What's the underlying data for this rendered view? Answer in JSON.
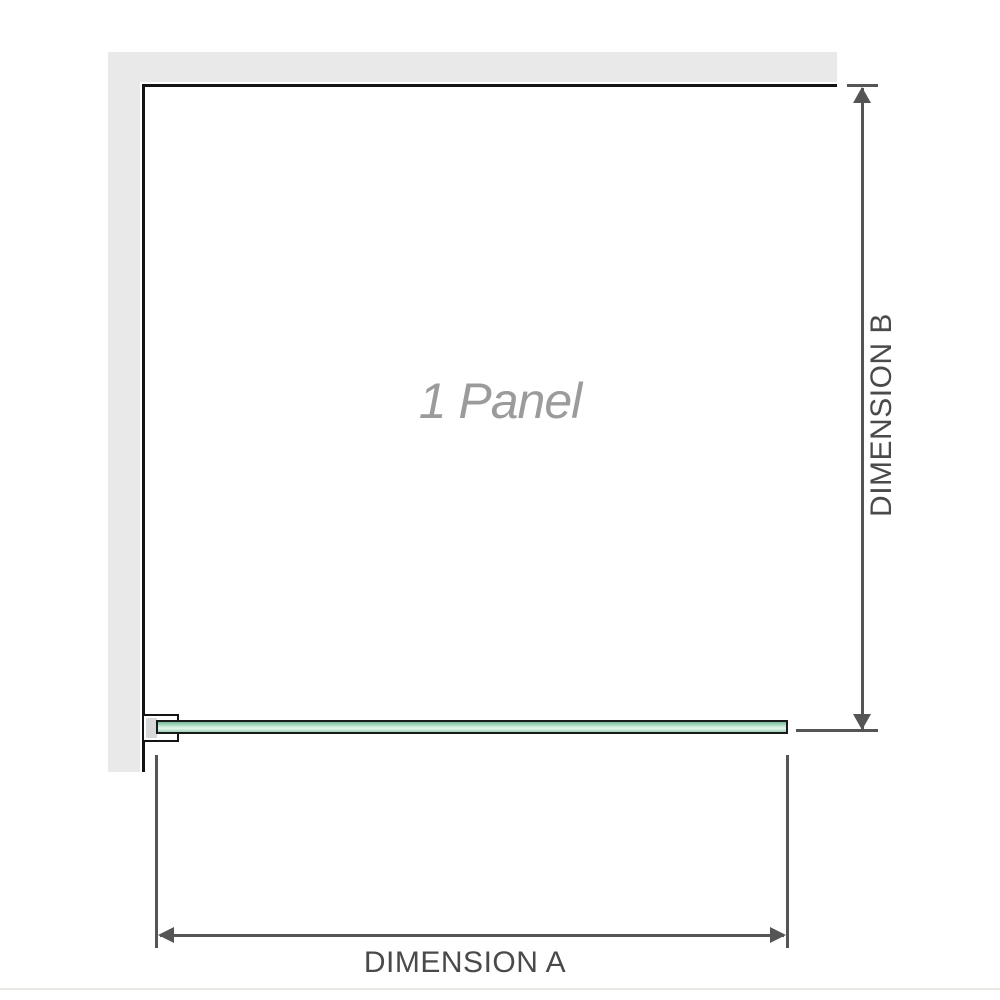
{
  "diagram": {
    "watermark_label": "1 Panel",
    "dimension_a_label": "DIMENSION A",
    "dimension_b_label": "DIMENSION B"
  },
  "colors": {
    "wall_fill": "#e9e9e9",
    "panel_outline": "#141414",
    "dimension_line": "#555555",
    "dimension_text": "#4a4a4a",
    "watermark_text": "#9b9b9b",
    "glass_border": "#1a1a1a",
    "glass_green_edge": "#79bb97",
    "glass_green_highlight": "#e7f7ee",
    "bracket_shim": "#d8d8d8",
    "bottom_rule": "#e8e8e3"
  }
}
